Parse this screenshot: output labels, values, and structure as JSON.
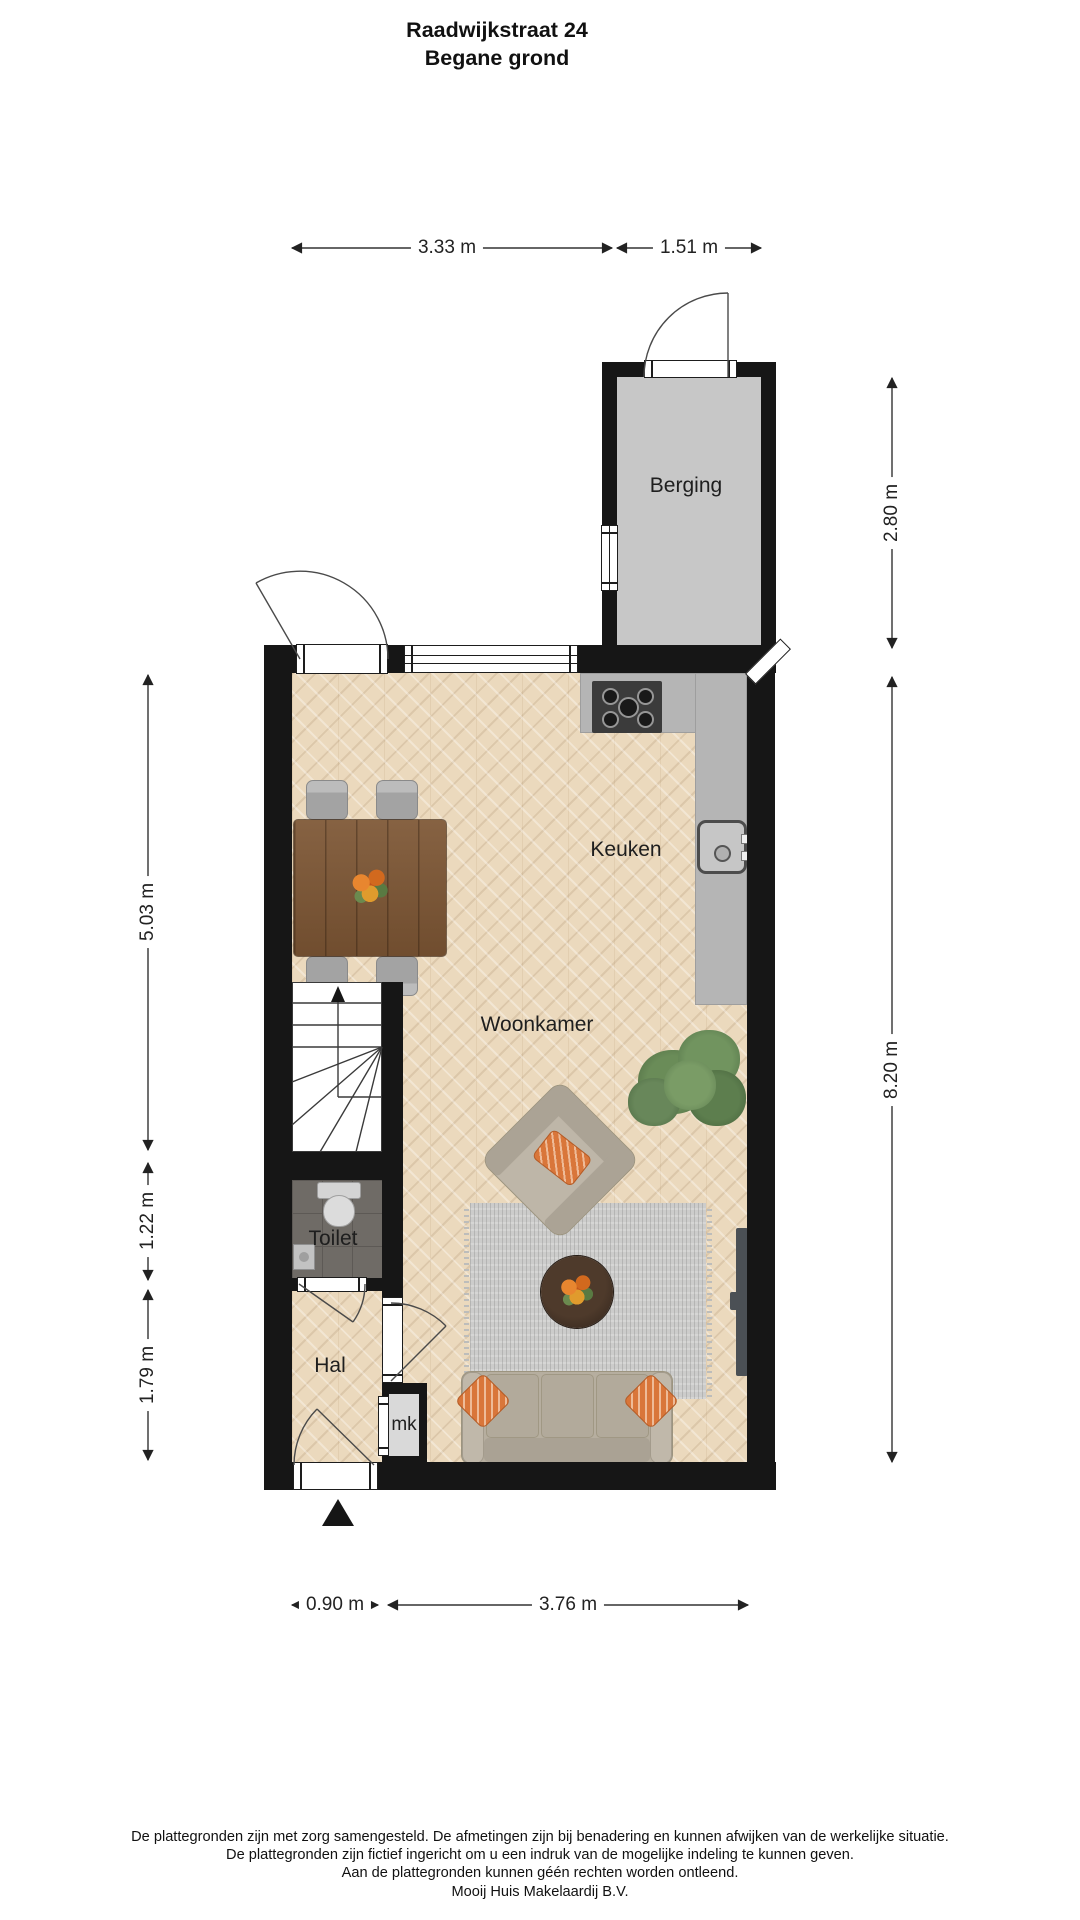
{
  "title": {
    "line1": "Raadwijkstraat 24",
    "line2": "Begane grond"
  },
  "rooms": {
    "berging": "Berging",
    "keuken": "Keuken",
    "woonkamer": "Woonkamer",
    "toilet": "Toilet",
    "hal": "Hal",
    "mk": "mk"
  },
  "dimensions": {
    "top_main": "3.33 m",
    "top_berging": "1.51 m",
    "right_berging": "2.80 m",
    "right_main": "8.20 m",
    "left_woonkamer": "5.03 m",
    "left_toilet": "1.22 m",
    "left_hal": "1.79 m",
    "bottom_hal": "0.90 m",
    "bottom_main": "3.76 m"
  },
  "footer": {
    "line1": "De plattegronden zijn met zorg samengesteld. De afmetingen zijn bij benadering en kunnen afwijken van de werkelijke situatie.",
    "line2": "De plattegronden zijn fictief ingericht om u een indruk van de mogelijke indeling te kunnen geven.",
    "line3": "Aan de plattegronden kunnen géén rechten worden ontleend.",
    "line4": "Mooij Huis Makelaardij B.V."
  },
  "icons": {
    "north_arrow": "north-arrow",
    "stairs_up_arrow": "stairs-up-arrow"
  },
  "furniture": [
    "dining-table",
    "dining-chairs",
    "kitchen-counter",
    "stove",
    "kitchen-sink",
    "stairs",
    "toilet",
    "hand-basin",
    "wall-tv",
    "armchair",
    "sofa",
    "rug",
    "coffee-table",
    "plant"
  ],
  "colors": {
    "wall": "#161616",
    "wood_floor": "#ebd9bd",
    "tile_floor": "#6f6b66",
    "berging_floor": "#c7c7c7",
    "counter": "#b5b5b5",
    "table_wood": "#7d5634",
    "sofa": "#b6ae9f",
    "rug": "#cccccb",
    "accent_orange": "#d9763a",
    "plant_green": "#5d7d50"
  }
}
